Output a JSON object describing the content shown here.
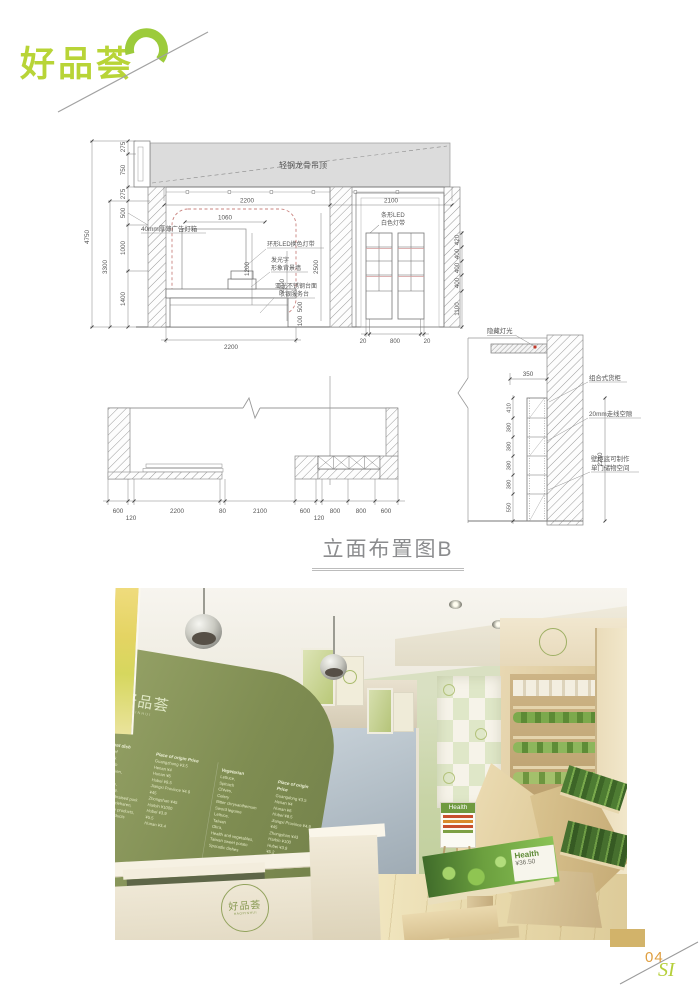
{
  "brand": {
    "logo": "好品荟",
    "page_no": "04",
    "si": "SI"
  },
  "page": {
    "title": "立面布置图B"
  },
  "elevation": {
    "labels": {
      "ceiling": "轻钢龙骨吊顶",
      "lightbox": "40mm厚薄广告灯箱",
      "ring_led": "环形LED换色灯带",
      "luminous_1": "发光字",
      "luminous_2": "形象背景墙",
      "counter_1": "亚光不锈钢台面",
      "counter_2": "收银服务台",
      "strip_led_1": "条形LED",
      "strip_led_2": "白色灯带"
    },
    "dims": {
      "overall_h": "4750",
      "upper_h": "3300",
      "segs": [
        "275",
        "750",
        "275",
        "500",
        "1000",
        "1400"
      ],
      "top_w": [
        "2200",
        "2100"
      ],
      "lightbox_w": "1060",
      "lightbox_h": "1200",
      "door_h": "2500",
      "wall_h": "2200",
      "counter_hs": [
        "500",
        "100"
      ],
      "bottom_w": "2200",
      "shelf_v": [
        "420",
        "400",
        "400",
        "400",
        "1100"
      ],
      "shelf_b": [
        "20",
        "800",
        "20"
      ]
    }
  },
  "plan": {
    "dims": [
      "600",
      "120",
      "2200",
      "80",
      "2100",
      "600",
      "120",
      "800",
      "800",
      "600"
    ]
  },
  "detail": {
    "labels": {
      "hidden_light": "隐藏灯光",
      "cabinet": "组合式货柜",
      "wiring": "20mm走线空隙",
      "storage_1": "壁柜底可制作",
      "storage_2": "单门储物空间"
    },
    "dims": {
      "depth": "350",
      "left": [
        "410",
        "380",
        "380",
        "380",
        "380",
        "550"
      ],
      "height": "2210"
    }
  },
  "photo": {
    "board": {
      "logo": "好品荟",
      "logo_sub": "HAOPINHUI",
      "menu": {
        "col1_header": "Meat dish",
        "col1": "Beef\nPork\nLamb\nChicken,\nDuck,\nGoose,\nDonkey,\nSauce braised pork\nMarkenzieharen,\nSausage products,\nHam products\nFish",
        "col2_header": "Place of origin  Price",
        "col2": "Guangzhong  ¥3.5\nHenan  ¥4\nHunan  ¥6\nHubei  ¥9.5\nJiangxi Province  ¥4.9\n¥45\nZhongshan  ¥45\nHarbin  ¥1000\nHubei  ¥3.9\n¥5.5\nHunan  ¥3.4",
        "col3_header": "Vegetarian",
        "col3": "Lettuce,\nSpinach\nChives,\nCelery\nBitter chrysanthemum\nSword legume\nLettuce,\nTaiwan\nOkra,\nHealth and vegetables,\nTaiwan sweet potato\nSporadic dishes",
        "col4_header": "Place of origin  Price",
        "col4": "Guangdong  ¥3.5\nHenan  ¥4\nHunan  ¥6\nHubei  ¥8.5\nJiangxi Province  ¥4.9\n¥45\nZhongshan  ¥43\nHarbin  ¥100\nHubei  ¥3.9\n¥5.2\n¥3.4\n¥4.2"
      }
    },
    "easel": {
      "header": "Health"
    },
    "table_sign": {
      "title": "Health",
      "price": "¥36.50"
    },
    "counter": {
      "logo": "好品荟",
      "logo_sub": "HAOPINHUI"
    }
  }
}
